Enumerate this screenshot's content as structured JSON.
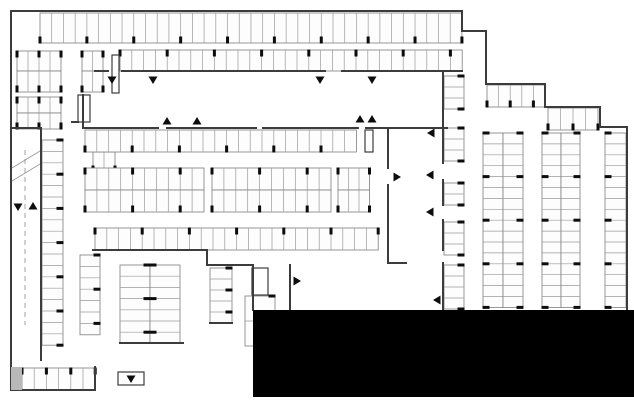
{
  "meta": {
    "kind": "parking-garage-floor-plan",
    "canvas": {
      "w": 634,
      "h": 400
    },
    "colors": {
      "background": "#ffffff",
      "wall": "#3c3c3c",
      "stall_outline": "#7d7d7d",
      "stall_divider": "#9a9a9a",
      "stall_fill": "#fdfdfd",
      "column_tick": "#0d0d0d",
      "arrow": "#0d0d0d",
      "redacted_block": "#000000",
      "shaded_block": "#b8b8b8",
      "ramp_line": "#9a9a9a"
    }
  },
  "plan": {
    "walls": [
      [
        11,
        11,
        462,
        11
      ],
      [
        11,
        11,
        11,
        390
      ],
      [
        11,
        390,
        95,
        390
      ],
      [
        95,
        367,
        95,
        390
      ],
      [
        462,
        11,
        462,
        31
      ],
      [
        462,
        31,
        486,
        31
      ],
      [
        486,
        31,
        486,
        84
      ],
      [
        486,
        84,
        545,
        84
      ],
      [
        545,
        84,
        545,
        107
      ],
      [
        545,
        107,
        600,
        107
      ],
      [
        600,
        107,
        600,
        127
      ],
      [
        600,
        127,
        627,
        127
      ],
      [
        627,
        127,
        627,
        312
      ],
      [
        95,
        71,
        108,
        71
      ],
      [
        122,
        71,
        325,
        71
      ],
      [
        342,
        71,
        462,
        71
      ],
      [
        83,
        128,
        158,
        128
      ],
      [
        167,
        128,
        256,
        128
      ],
      [
        263,
        128,
        358,
        128
      ],
      [
        366,
        128,
        447,
        128
      ],
      [
        388,
        128,
        388,
        168
      ],
      [
        388,
        185,
        388,
        248
      ],
      [
        388,
        248,
        388,
        263
      ],
      [
        388,
        263,
        406,
        263
      ],
      [
        93,
        250,
        207,
        250
      ],
      [
        207,
        250,
        207,
        265
      ],
      [
        207,
        265,
        253,
        265
      ],
      [
        290,
        265,
        290,
        330
      ],
      [
        253,
        265,
        253,
        310
      ],
      [
        443,
        71,
        443,
        163
      ],
      [
        443,
        180,
        443,
        205
      ],
      [
        443,
        220,
        443,
        250
      ],
      [
        443,
        263,
        443,
        310
      ],
      [
        83,
        95,
        83,
        128
      ],
      [
        72,
        122,
        78,
        122
      ],
      [
        11,
        128,
        41,
        128
      ],
      [
        41,
        128,
        41,
        360
      ],
      [
        210,
        323,
        232,
        323
      ],
      [
        120,
        343,
        183,
        343
      ]
    ],
    "stall_rows": [
      {
        "name": "top-row",
        "x": 40,
        "y": 13,
        "count": 36,
        "pitch": 11.72,
        "depth": 30,
        "orient": "v",
        "ticks": "bottom",
        "every": 4
      },
      {
        "name": "band2-group1-upper",
        "x": 17,
        "y": 51,
        "count": 4,
        "pitch": 11,
        "depth": 20,
        "orient": "v",
        "ticks": "top",
        "every": 2
      },
      {
        "name": "band2-group1-lower",
        "x": 17,
        "y": 71,
        "count": 4,
        "pitch": 11,
        "depth": 21,
        "orient": "v",
        "ticks": "bottom",
        "every": 2
      },
      {
        "name": "band2-group2-upper",
        "x": 82,
        "y": 51,
        "count": 2,
        "pitch": 10.5,
        "depth": 20,
        "orient": "v",
        "ticks": "top",
        "every": 2
      },
      {
        "name": "band2-group2-lower",
        "x": 82,
        "y": 71,
        "count": 2,
        "pitch": 10.5,
        "depth": 21,
        "orient": "v",
        "ticks": "bottom",
        "every": 2
      },
      {
        "name": "band2-long-row",
        "x": 120,
        "y": 50,
        "count": 29,
        "pitch": 11.8,
        "depth": 21,
        "orient": "v",
        "ticks": "top",
        "every": 4
      },
      {
        "name": "band3-group-upper",
        "x": 17,
        "y": 97,
        "count": 4,
        "pitch": 11,
        "depth": 16,
        "orient": "v",
        "ticks": "top",
        "every": 2
      },
      {
        "name": "band3-group-lower",
        "x": 17,
        "y": 113,
        "count": 4,
        "pitch": 11,
        "depth": 16,
        "orient": "v",
        "ticks": "bottom",
        "every": 2
      },
      {
        "name": "west-small-group-upper",
        "x": 93,
        "y": 132,
        "count": 2,
        "pitch": 11,
        "depth": 20,
        "orient": "v",
        "ticks": "top",
        "every": 2
      },
      {
        "name": "west-small-group-lower",
        "x": 93,
        "y": 152,
        "count": 2,
        "pitch": 11,
        "depth": 20,
        "orient": "v",
        "ticks": "bottom",
        "every": 2
      },
      {
        "name": "northeast-step-row-1",
        "x": 487,
        "y": 85,
        "count": 5,
        "pitch": 11.6,
        "depth": 22,
        "orient": "v",
        "ticks": "bottom",
        "every": 2
      },
      {
        "name": "northeast-step-row-2",
        "x": 548,
        "y": 108,
        "count": 4,
        "pitch": 12.5,
        "depth": 22,
        "orient": "v",
        "ticks": "bottom",
        "every": 2
      },
      {
        "name": "center-row-1",
        "x": 85,
        "y": 130,
        "count": 23,
        "pitch": 11.8,
        "depth": 22,
        "orient": "v",
        "ticks": "bottom",
        "every": 4
      },
      {
        "name": "center-double-a-upper",
        "x": 85,
        "y": 168,
        "count": 10,
        "pitch": 11.9,
        "depth": 22,
        "orient": "v",
        "ticks": "top",
        "every": 4
      },
      {
        "name": "center-double-a-lower",
        "x": 85,
        "y": 190,
        "count": 10,
        "pitch": 11.9,
        "depth": 22,
        "orient": "v",
        "ticks": "bottom",
        "every": 4
      },
      {
        "name": "center-double-b-upper",
        "x": 212,
        "y": 168,
        "count": 10,
        "pitch": 11.9,
        "depth": 22,
        "orient": "v",
        "ticks": "top",
        "every": 4
      },
      {
        "name": "center-double-b-lower",
        "x": 212,
        "y": 190,
        "count": 10,
        "pitch": 11.9,
        "depth": 22,
        "orient": "v",
        "ticks": "bottom",
        "every": 4
      },
      {
        "name": "center-double-c-upper",
        "x": 338,
        "y": 168,
        "count": 3,
        "pitch": 10.5,
        "depth": 22,
        "orient": "v",
        "ticks": "top",
        "every": 3
      },
      {
        "name": "center-double-c-lower",
        "x": 338,
        "y": 190,
        "count": 3,
        "pitch": 10.5,
        "depth": 22,
        "orient": "v",
        "ticks": "bottom",
        "every": 3
      },
      {
        "name": "center-row-4",
        "x": 95,
        "y": 228,
        "count": 24,
        "pitch": 11.8,
        "depth": 22,
        "orient": "v",
        "ticks": "top",
        "every": 4
      },
      {
        "name": "southwest-bottom-row",
        "x": 22,
        "y": 368,
        "count": 6,
        "pitch": 12.2,
        "depth": 22,
        "orient": "v",
        "ticks": "top",
        "every": 2
      },
      {
        "name": "west-column",
        "x": 42,
        "y": 140,
        "count": 18,
        "pitch": 11.4,
        "depth": 21,
        "orient": "h",
        "ticks": "right",
        "every": 3
      },
      {
        "name": "mid-column-1",
        "x": 80,
        "y": 255,
        "count": 7,
        "pitch": 11.4,
        "depth": 20,
        "orient": "h",
        "ticks": "right",
        "every": 3
      },
      {
        "name": "mid-column-2-left",
        "x": 120,
        "y": 265,
        "count": 7,
        "pitch": 11.2,
        "depth": 30,
        "orient": "h",
        "ticks": "right",
        "every": 3
      },
      {
        "name": "mid-column-2-right",
        "x": 150,
        "y": 265,
        "count": 7,
        "pitch": 11.2,
        "depth": 30,
        "orient": "h",
        "ticks": "left",
        "every": 3
      },
      {
        "name": "mid-column-3",
        "x": 210,
        "y": 268,
        "count": 5,
        "pitch": 11,
        "depth": 22,
        "orient": "h",
        "ticks": "right",
        "every": 2
      },
      {
        "name": "mid-large-stalls",
        "x": 245,
        "y": 296,
        "count": 2,
        "pitch": 25,
        "depth": 30,
        "orient": "h",
        "ticks": "right",
        "every": 1
      },
      {
        "name": "east-strip1-seg1",
        "x": 444,
        "y": 76,
        "count": 3,
        "pitch": 11,
        "depth": 20,
        "orient": "h",
        "ticks": "right",
        "every": 3
      },
      {
        "name": "east-strip1-seg2",
        "x": 444,
        "y": 128,
        "count": 3,
        "pitch": 11,
        "depth": 20,
        "orient": "h",
        "ticks": "right",
        "every": 3
      },
      {
        "name": "east-strip1-seg3",
        "x": 444,
        "y": 183,
        "count": 2,
        "pitch": 11,
        "depth": 20,
        "orient": "h",
        "ticks": "right",
        "every": 2
      },
      {
        "name": "east-strip1-seg4",
        "x": 444,
        "y": 222,
        "count": 3,
        "pitch": 11,
        "depth": 20,
        "orient": "h",
        "ticks": "right",
        "every": 3
      },
      {
        "name": "east-strip1-seg5",
        "x": 444,
        "y": 265,
        "count": 4,
        "pitch": 11,
        "depth": 20,
        "orient": "h",
        "ticks": "right",
        "every": 4
      },
      {
        "name": "east-strip2-left",
        "x": 483,
        "y": 133,
        "count": 16,
        "pitch": 10.9,
        "depth": 20,
        "orient": "h",
        "ticks": "left",
        "every": 4
      },
      {
        "name": "east-strip2-right",
        "x": 503,
        "y": 133,
        "count": 16,
        "pitch": 10.9,
        "depth": 20,
        "orient": "h",
        "ticks": "right",
        "every": 4
      },
      {
        "name": "east-strip3-left",
        "x": 542,
        "y": 133,
        "count": 16,
        "pitch": 10.9,
        "depth": 19,
        "orient": "h",
        "ticks": "left",
        "every": 4
      },
      {
        "name": "east-strip3-right",
        "x": 561,
        "y": 133,
        "count": 16,
        "pitch": 10.9,
        "depth": 19,
        "orient": "h",
        "ticks": "right",
        "every": 4
      },
      {
        "name": "east-strip4",
        "x": 605,
        "y": 133,
        "count": 16,
        "pitch": 10.9,
        "depth": 21,
        "orient": "h",
        "ticks": "left",
        "every": 4
      }
    ],
    "shafts": [
      {
        "name": "elevator-shaft-west",
        "x": 78,
        "y": 95,
        "w": 12,
        "h": 27
      },
      {
        "name": "shaft-north",
        "x": 112,
        "y": 55,
        "w": 7,
        "h": 38
      },
      {
        "name": "shaft-center",
        "x": 365,
        "y": 130,
        "w": 8,
        "h": 22
      },
      {
        "name": "exit-arrow-box",
        "x": 118,
        "y": 372,
        "w": 26,
        "h": 13
      },
      {
        "name": "stair-core",
        "x": 252,
        "y": 268,
        "w": 16,
        "h": 27
      }
    ],
    "lines": [
      {
        "x1": 252,
        "y1": 274,
        "x2": 268,
        "y2": 274
      },
      {
        "x1": 252,
        "y1": 280,
        "x2": 268,
        "y2": 280
      },
      {
        "x1": 252,
        "y1": 286,
        "x2": 268,
        "y2": 286
      },
      {
        "x1": 12,
        "y1": 181,
        "x2": 40,
        "y2": 164
      },
      {
        "x1": 12,
        "y1": 168,
        "x2": 40,
        "y2": 151
      },
      {
        "x1": 25,
        "y1": 150,
        "x2": 25,
        "y2": 325,
        "dash": true
      }
    ],
    "arrows": [
      {
        "dir": "down",
        "x": 112,
        "y": 80
      },
      {
        "dir": "down",
        "x": 153,
        "y": 80
      },
      {
        "dir": "down",
        "x": 320,
        "y": 80
      },
      {
        "dir": "down",
        "x": 372,
        "y": 80
      },
      {
        "dir": "up",
        "x": 167,
        "y": 121
      },
      {
        "dir": "up",
        "x": 197,
        "y": 121
      },
      {
        "dir": "up",
        "x": 360,
        "y": 119
      },
      {
        "dir": "up",
        "x": 372,
        "y": 119
      },
      {
        "dir": "down",
        "x": 18,
        "y": 207
      },
      {
        "dir": "up",
        "x": 33,
        "y": 206
      },
      {
        "dir": "down",
        "x": 131,
        "y": 379
      },
      {
        "dir": "right",
        "x": 397,
        "y": 177
      },
      {
        "dir": "right",
        "x": 297,
        "y": 281
      },
      {
        "dir": "left",
        "x": 431,
        "y": 133
      },
      {
        "dir": "left",
        "x": 430,
        "y": 175
      },
      {
        "dir": "left",
        "x": 430,
        "y": 212
      },
      {
        "dir": "left",
        "x": 437,
        "y": 300
      }
    ],
    "blocks": [
      {
        "name": "redacted-block",
        "x": 253,
        "y": 310,
        "w": 381,
        "h": 87,
        "fill": "#000000"
      },
      {
        "name": "shaded-corner-block",
        "x": 11,
        "y": 367,
        "w": 11,
        "h": 23,
        "fill": "#b8b8b8"
      }
    ]
  }
}
